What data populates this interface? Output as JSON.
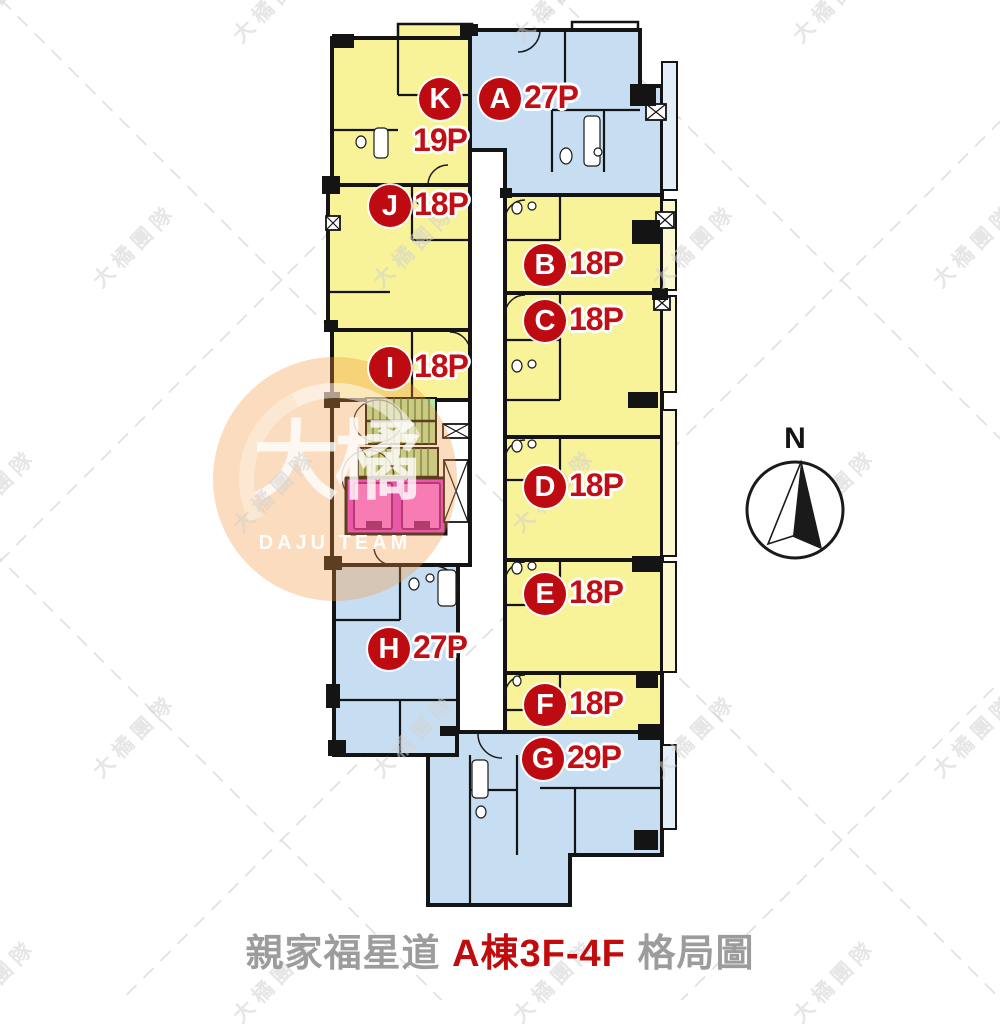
{
  "title": {
    "prefix": "親家福星道 ",
    "building": "A棟3F-4F",
    "suffix": " 格局圖"
  },
  "compass": {
    "label": "N"
  },
  "watermark": {
    "pattern_text": "大橘團隊"
  },
  "logo": {
    "cn": "大橘",
    "en": "DAJU TEAM"
  },
  "units": [
    {
      "label": "A",
      "capacity": "27P",
      "color_key": "blue"
    },
    {
      "label": "B",
      "capacity": "18P",
      "color_key": "yellow"
    },
    {
      "label": "C",
      "capacity": "18P",
      "color_key": "yellow"
    },
    {
      "label": "D",
      "capacity": "18P",
      "color_key": "yellow"
    },
    {
      "label": "E",
      "capacity": "18P",
      "color_key": "yellow"
    },
    {
      "label": "F",
      "capacity": "18P",
      "color_key": "yellow"
    },
    {
      "label": "G",
      "capacity": "29P",
      "color_key": "blue"
    },
    {
      "label": "H",
      "capacity": "27P",
      "color_key": "blue"
    },
    {
      "label": "I",
      "capacity": "18P",
      "color_key": "yellow"
    },
    {
      "label": "J",
      "capacity": "18P",
      "color_key": "yellow"
    },
    {
      "label": "K",
      "capacity": "19P",
      "color_key": "yellow"
    }
  ],
  "core": {
    "elevator_count": 2,
    "stair_flight_count": 2
  },
  "colors": {
    "unit_yellow": "#F8F299",
    "unit_blue": "#C7DEF2",
    "balcony_yellow": "#FBF7CE",
    "balcony_blue": "#E3EEF9",
    "badge_red": "#BE0B12",
    "count_red": "#C20F16",
    "wall_black": "#141414",
    "stair_green": "#B9E3A8",
    "stair_tread": "#3E7A3E",
    "elevator_pink": "#E93BE0",
    "elevator_car_pink": "#FB71F1",
    "title_gray": "#9C9C9C",
    "title_red": "#C00C0C",
    "watermark_gray": "#D2D2D2",
    "logo_orange": "#F3963B"
  }
}
